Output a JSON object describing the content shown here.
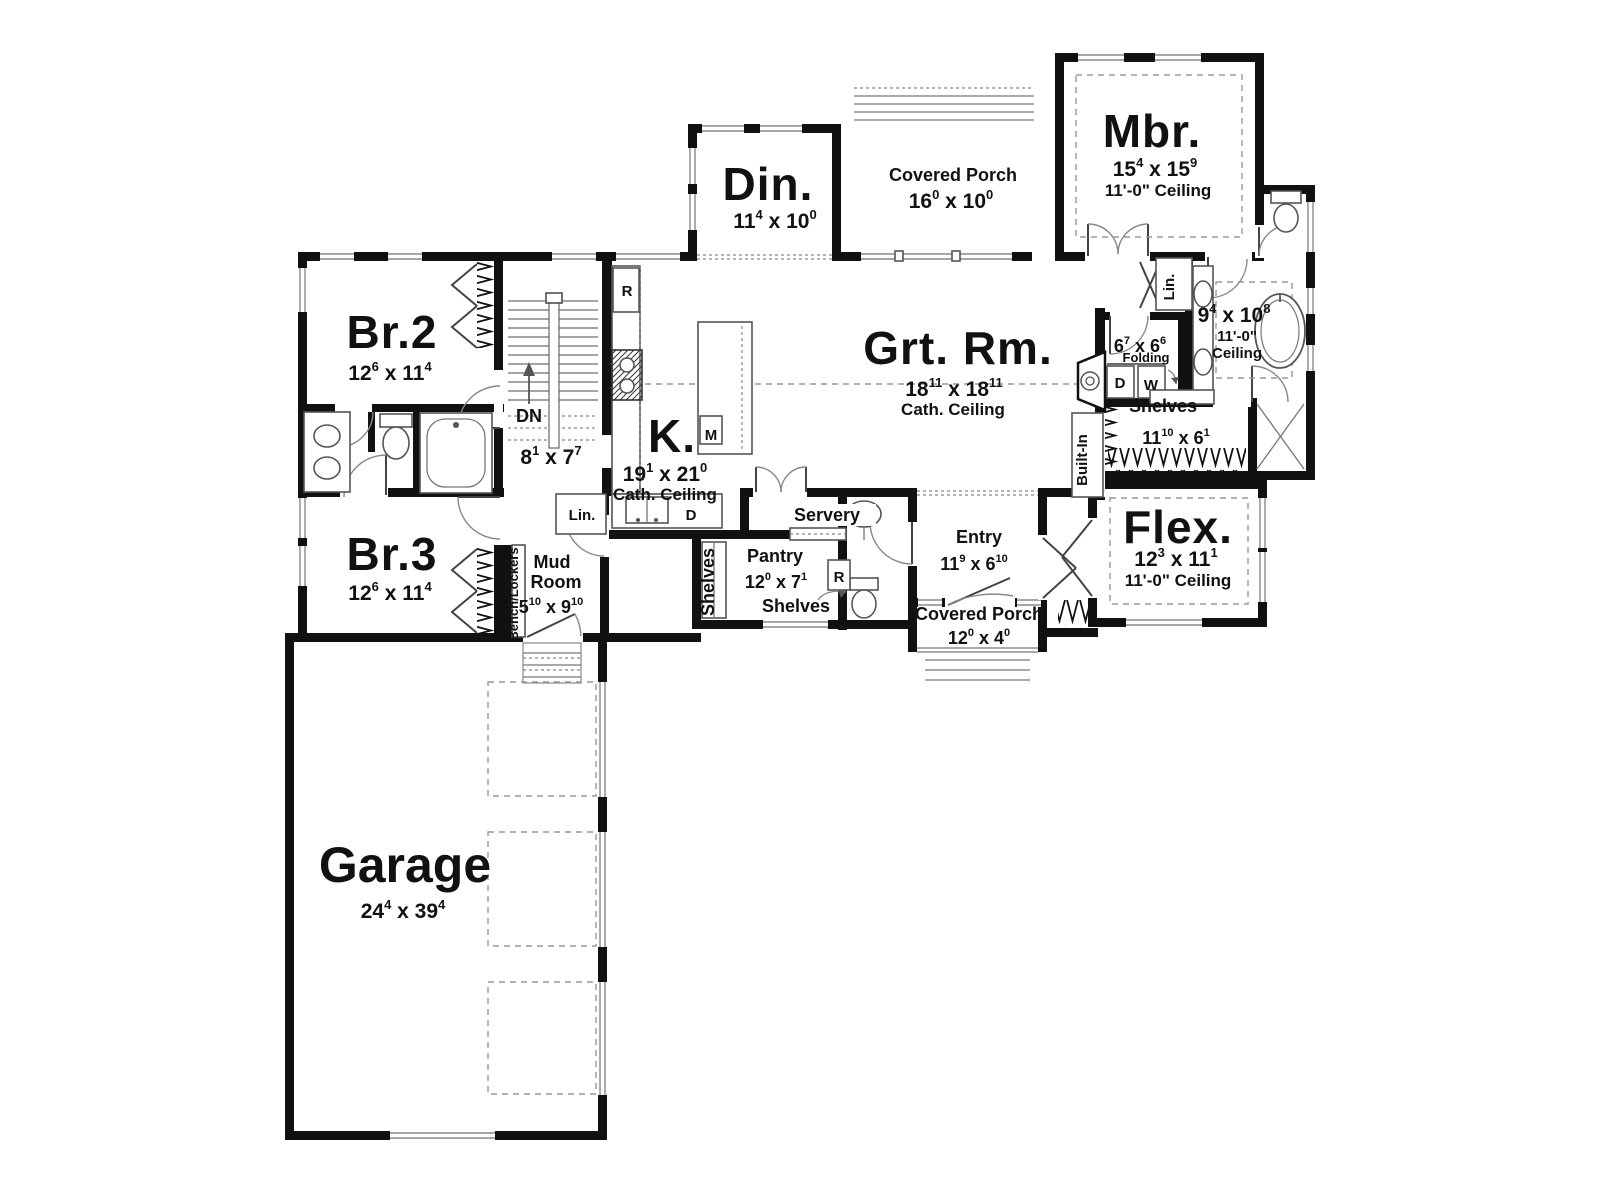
{
  "rooms": {
    "br2": {
      "name": "Br.2",
      "a": "12",
      "as": "6",
      "b": " x 11",
      "bs": "4"
    },
    "br3": {
      "name": "Br.3",
      "a": "12",
      "as": "6",
      "b": " x 11",
      "bs": "4"
    },
    "garage": {
      "name": "Garage",
      "a": "24",
      "as": "4",
      "b": " x 39",
      "bs": "4"
    },
    "mud": {
      "l1": "Mud",
      "l2": "Room",
      "a": "5",
      "as": "10",
      "b": " x 9",
      "bs": "10",
      "lin": "Lin."
    },
    "kitchen": {
      "name": "K.",
      "a": "19",
      "as": "1",
      "b": " x 21",
      "bs": "0",
      "ceil": "Cath. Ceiling",
      "fridge": "R",
      "micro": "M",
      "dish": "D"
    },
    "din": {
      "name": "Din.",
      "a": "11",
      "as": "4",
      "b": " x 10",
      "bs": "0"
    },
    "porch_top": {
      "name": "Covered Porch",
      "a": "16",
      "as": "0",
      "b": " x 10",
      "bs": "0"
    },
    "grt": {
      "name": "Grt. Rm.",
      "a": "18",
      "as": "11",
      "b": " x 18",
      "bs": "11",
      "ceil": "Cath. Ceiling",
      "built_in": "Built-In"
    },
    "mbr": {
      "name": "Mbr.",
      "a": "15",
      "as": "4",
      "b": " x 15",
      "bs": "9",
      "ceil": "11'-0\" Ceiling"
    },
    "mbath": {
      "a": "9",
      "as": "4",
      "b": " x 10",
      "bs": "8",
      "ceil1": "11'-0\"",
      "ceil2": "Ceiling",
      "lin": "Lin."
    },
    "laundry": {
      "a": "6",
      "as": "7",
      "b": " x 6",
      "bs": "6",
      "folding": "Folding",
      "dryer": "D",
      "washer": "W"
    },
    "wic": {
      "label": "Shelves",
      "a": "11",
      "as": "10",
      "b": " x 6",
      "bs": "1"
    },
    "flex": {
      "name": "Flex.",
      "a": "12",
      "as": "3",
      "b": " x 11",
      "bs": "1",
      "ceil": "11'-0\" Ceiling"
    },
    "entry": {
      "name": "Entry",
      "a": "11",
      "as": "9",
      "b": " x 6",
      "bs": "10"
    },
    "porch_front": {
      "name": "Covered Porch",
      "a": "12",
      "as": "0",
      "b": " x 4",
      "bs": "0"
    },
    "pantry": {
      "name": "Pantry",
      "a": "12",
      "as": "0",
      "b": " x 7",
      "bs": "1",
      "shelves": "Shelves",
      "shelves2": "Shelves",
      "fridge": "R"
    },
    "servery": {
      "name": "Servery"
    },
    "stairs": {
      "dn": "DN",
      "a": "8",
      "as": "1",
      "b": " x 7",
      "bs": "7"
    },
    "hall": {
      "bench": "Bench/Lockers"
    }
  },
  "colors": {
    "wall": "#111111",
    "line": "#777777",
    "text": "#111111",
    "bg": "#ffffff"
  }
}
